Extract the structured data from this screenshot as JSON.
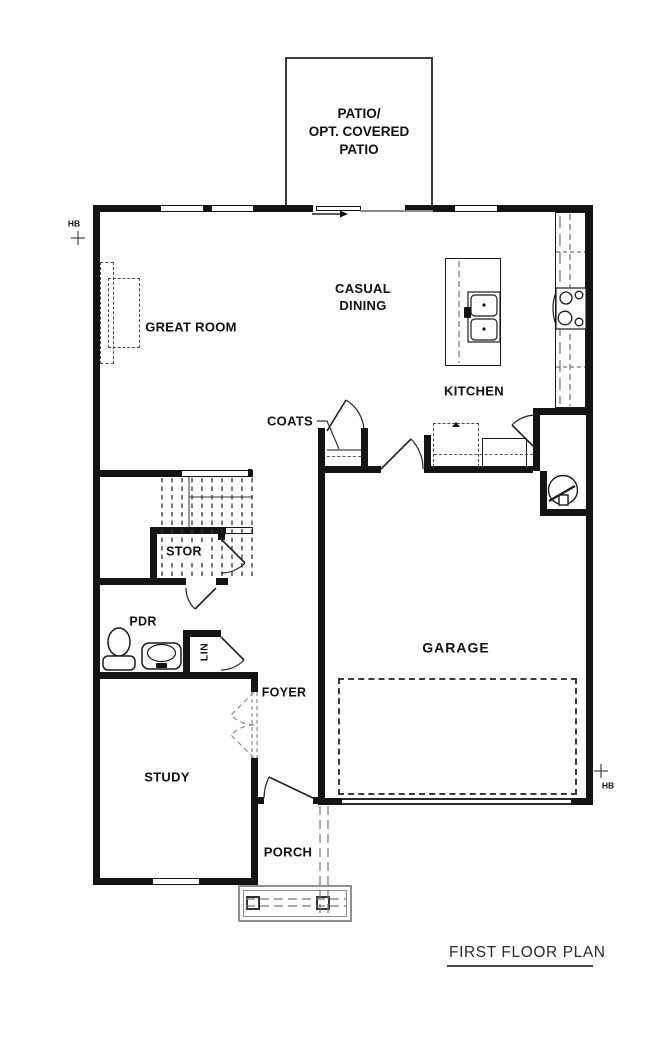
{
  "title": {
    "text": "FIRST FLOOR PLAN"
  },
  "rooms": {
    "patio": "PATIO/\nOPT. COVERED\nPATIO",
    "great_room": "GREAT ROOM",
    "casual_dining": "CASUAL\nDINING",
    "kitchen": "KITCHEN",
    "coats": "COATS",
    "stor": "STOR",
    "pdr": "PDR",
    "lin": "LIN",
    "foyer": "FOYER",
    "garage": "GARAGE",
    "study": "STUDY",
    "porch": "PORCH"
  },
  "annotations": {
    "hose_bib_left": "HB",
    "hose_bib_right": "HB"
  },
  "colors": {
    "wall": "#141414",
    "thin_line": "#2a2a2a",
    "dashed_line": "#4a4a4a",
    "porch_line": "#8f8f8f",
    "background": "#ffffff"
  }
}
